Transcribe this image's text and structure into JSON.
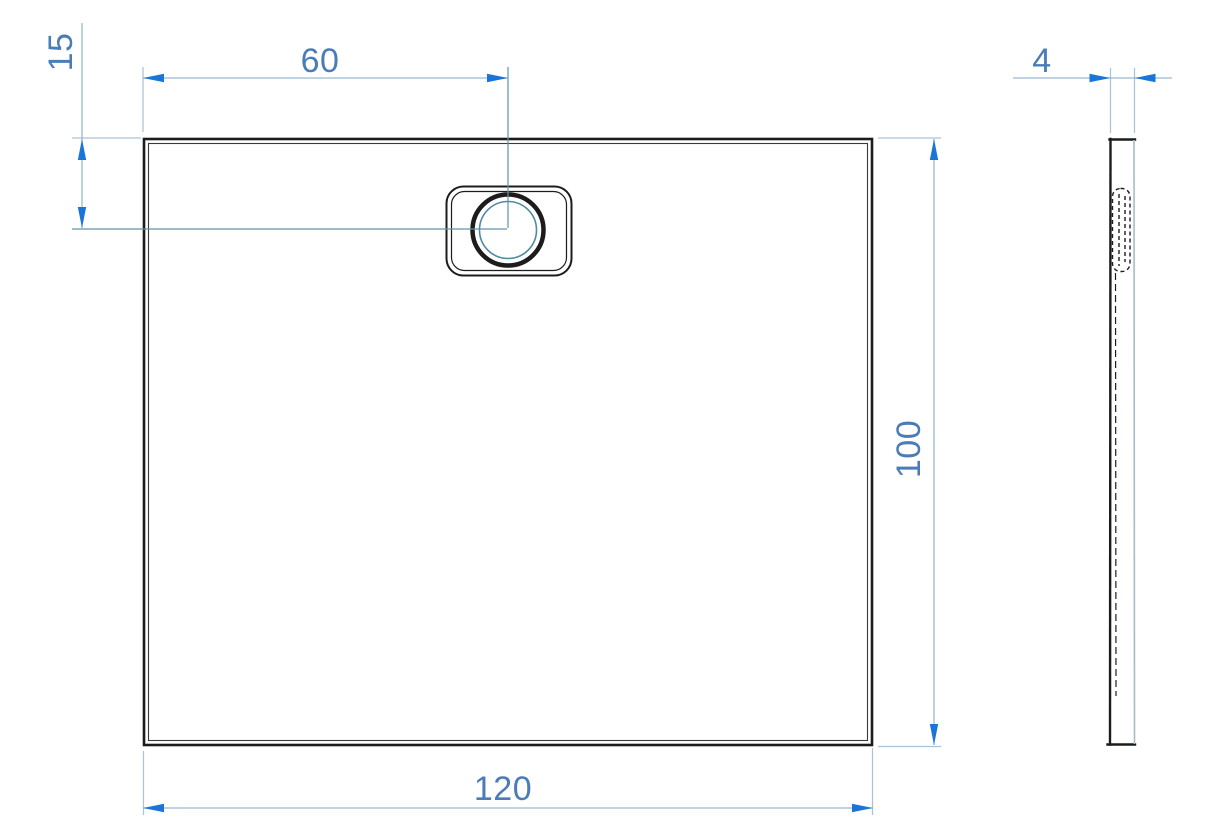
{
  "dimensions": {
    "tray_width": "120",
    "tray_depth": "100",
    "drain_center_from_left": "60",
    "drain_center_from_top": "15",
    "tray_thickness": "4"
  },
  "colors": {
    "background": "#ffffff",
    "line_black": "#1c1c1c",
    "inner_line": "#3a3a3a",
    "dim_text": "#4a7cb8",
    "arrow": "#1b75d8",
    "dim_line": "#9cb8ce",
    "ext_line": "#a9c2d6",
    "centerline": "#5f93ad",
    "drain_inner_circle": "#4f8aa3",
    "side_right_edge": "#a5bdc5"
  }
}
